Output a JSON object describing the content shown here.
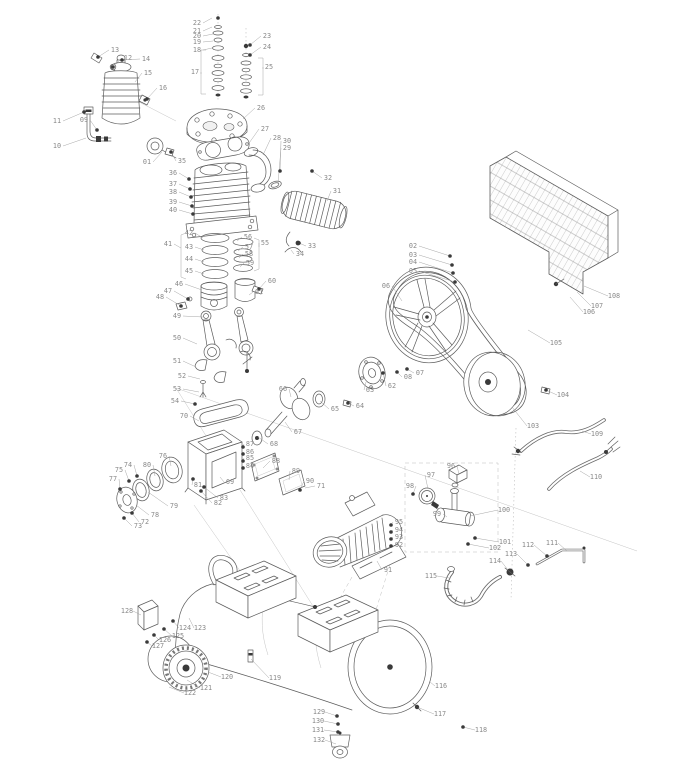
{
  "figure": {
    "kind": "exploded-parts-diagram",
    "subject": "belt-driven air compressor"
  },
  "colors": {
    "line": "#5c5c5c",
    "label": "#8a8a8a",
    "fastener": "#3a3a3a",
    "background": "#ffffff"
  },
  "parts": [
    {
      "n": "01",
      "x": 147,
      "y": 164,
      "tx": 162,
      "ty": 152,
      "f": 0
    },
    {
      "n": "02",
      "x": 413,
      "y": 248,
      "tx": 450,
      "ty": 256,
      "f": 1
    },
    {
      "n": "03",
      "x": 413,
      "y": 257,
      "tx": 452,
      "ty": 265,
      "f": 1
    },
    {
      "n": "04",
      "x": 413,
      "y": 264,
      "tx": 453,
      "ty": 273,
      "f": 1
    },
    {
      "n": "05",
      "x": 413,
      "y": 273,
      "tx": 455,
      "ty": 282,
      "f": 1
    },
    {
      "n": "06",
      "x": 386,
      "y": 288,
      "tx": 402,
      "ty": 301,
      "f": 0
    },
    {
      "n": "07",
      "x": 420,
      "y": 375,
      "tx": 407,
      "ty": 369,
      "f": 1
    },
    {
      "n": "08",
      "x": 408,
      "y": 379,
      "tx": 397,
      "ty": 372,
      "f": 1
    },
    {
      "n": "09",
      "x": 84,
      "y": 122,
      "tx": 97,
      "ty": 130,
      "f": 1
    },
    {
      "n": "10",
      "x": 57,
      "y": 148,
      "tx": 86,
      "ty": 138,
      "f": 0
    },
    {
      "n": "11",
      "x": 57,
      "y": 123,
      "tx": 84,
      "ty": 112,
      "f": 1
    },
    {
      "n": "12",
      "x": 128,
      "y": 60,
      "tx": 113,
      "ty": 67,
      "f": 1
    },
    {
      "n": "13",
      "x": 115,
      "y": 52,
      "tx": 98,
      "ty": 57,
      "f": 1
    },
    {
      "n": "14",
      "x": 146,
      "y": 61,
      "tx": 122,
      "ty": 60,
      "f": 1
    },
    {
      "n": "15",
      "x": 148,
      "y": 75,
      "tx": 135,
      "ty": 82,
      "f": 0
    },
    {
      "n": "16",
      "x": 163,
      "y": 90,
      "tx": 147,
      "ty": 99,
      "f": 1
    },
    {
      "n": "17",
      "x": 195,
      "y": 74,
      "tx": 201,
      "ty": 74,
      "f": 0
    },
    {
      "n": "18",
      "x": 197,
      "y": 52,
      "tx": 212,
      "ty": 48,
      "f": 0
    },
    {
      "n": "19",
      "x": 197,
      "y": 44,
      "tx": 213,
      "ty": 41,
      "f": 0
    },
    {
      "n": "20",
      "x": 197,
      "y": 38,
      "tx": 213,
      "ty": 34,
      "f": 0
    },
    {
      "n": "21",
      "x": 197,
      "y": 33,
      "tx": 212,
      "ty": 27,
      "f": 0
    },
    {
      "n": "22",
      "x": 197,
      "y": 25,
      "tx": 212,
      "ty": 18,
      "f": 0
    },
    {
      "n": "23",
      "x": 267,
      "y": 38,
      "tx": 250,
      "ty": 45,
      "f": 1
    },
    {
      "n": "24",
      "x": 267,
      "y": 49,
      "tx": 250,
      "ty": 55,
      "f": 1
    },
    {
      "n": "25",
      "x": 269,
      "y": 69,
      "tx": 263,
      "ty": 69,
      "f": 0
    },
    {
      "n": "26",
      "x": 261,
      "y": 110,
      "tx": 243,
      "ty": 119,
      "f": 0
    },
    {
      "n": "27",
      "x": 265,
      "y": 131,
      "tx": 247,
      "ty": 146,
      "f": 0
    },
    {
      "n": "28",
      "x": 277,
      "y": 140,
      "tx": 263,
      "ty": 155,
      "f": 0
    },
    {
      "n": "29",
      "x": 287,
      "y": 150,
      "tx": 278,
      "ty": 184,
      "f": 0
    },
    {
      "n": "30",
      "x": 287,
      "y": 143,
      "tx": 280,
      "ty": 171,
      "f": 1
    },
    {
      "n": "31",
      "x": 337,
      "y": 193,
      "tx": 327,
      "ty": 201,
      "f": 0
    },
    {
      "n": "32",
      "x": 328,
      "y": 180,
      "tx": 312,
      "ty": 171,
      "f": 1
    },
    {
      "n": "33",
      "x": 312,
      "y": 248,
      "tx": 299,
      "ty": 243,
      "f": 1
    },
    {
      "n": "34",
      "x": 300,
      "y": 256,
      "tx": 291,
      "ty": 250,
      "f": 0
    },
    {
      "n": "35",
      "x": 182,
      "y": 163,
      "tx": 171,
      "ty": 152,
      "f": 1
    },
    {
      "n": "36",
      "x": 173,
      "y": 175,
      "tx": 189,
      "ty": 179,
      "f": 1
    },
    {
      "n": "37",
      "x": 173,
      "y": 186,
      "tx": 190,
      "ty": 189,
      "f": 1
    },
    {
      "n": "38",
      "x": 173,
      "y": 194,
      "tx": 191,
      "ty": 197,
      "f": 1
    },
    {
      "n": "39",
      "x": 173,
      "y": 204,
      "tx": 192,
      "ty": 206,
      "f": 1
    },
    {
      "n": "40",
      "x": 173,
      "y": 212,
      "tx": 193,
      "ty": 214,
      "f": 1
    },
    {
      "n": "41",
      "x": 168,
      "y": 246,
      "tx": 181,
      "ty": 248,
      "f": 0
    },
    {
      "n": "42",
      "x": 189,
      "y": 235,
      "tx": 203,
      "ty": 238,
      "f": 0
    },
    {
      "n": "43",
      "x": 189,
      "y": 249,
      "tx": 204,
      "ty": 250,
      "f": 0
    },
    {
      "n": "44",
      "x": 189,
      "y": 261,
      "tx": 204,
      "ty": 262,
      "f": 0
    },
    {
      "n": "45",
      "x": 189,
      "y": 273,
      "tx": 204,
      "ty": 274,
      "f": 0
    },
    {
      "n": "46",
      "x": 179,
      "y": 286,
      "tx": 202,
      "ty": 290,
      "f": 0
    },
    {
      "n": "47",
      "x": 168,
      "y": 293,
      "tx": 188,
      "ty": 299,
      "f": 1
    },
    {
      "n": "48",
      "x": 160,
      "y": 299,
      "tx": 181,
      "ty": 306,
      "f": 1
    },
    {
      "n": "49",
      "x": 177,
      "y": 318,
      "tx": 203,
      "ty": 317,
      "f": 0
    },
    {
      "n": "50",
      "x": 177,
      "y": 340,
      "tx": 197,
      "ty": 344,
      "f": 0
    },
    {
      "n": "51",
      "x": 177,
      "y": 363,
      "tx": 196,
      "ty": 367,
      "f": 0
    },
    {
      "n": "52",
      "x": 182,
      "y": 378,
      "tx": 200,
      "ty": 379,
      "f": 0
    },
    {
      "n": "53",
      "x": 177,
      "y": 391,
      "tx": 199,
      "ty": 392,
      "f": 0
    },
    {
      "n": "54",
      "x": 175,
      "y": 403,
      "tx": 195,
      "ty": 404,
      "f": 1
    },
    {
      "n": "55",
      "x": 265,
      "y": 245,
      "tx": 259,
      "ty": 247,
      "f": 0
    },
    {
      "n": "56",
      "x": 248,
      "y": 239,
      "tx": 237,
      "ty": 241,
      "f": 0
    },
    {
      "n": "57",
      "x": 249,
      "y": 249,
      "tx": 238,
      "ty": 251,
      "f": 0
    },
    {
      "n": "58",
      "x": 249,
      "y": 256,
      "tx": 239,
      "ty": 258,
      "f": 0
    },
    {
      "n": "59",
      "x": 250,
      "y": 265,
      "tx": 240,
      "ty": 267,
      "f": 0
    },
    {
      "n": "60",
      "x": 272,
      "y": 283,
      "tx": 259,
      "ty": 289,
      "f": 1
    },
    {
      "n": "61",
      "x": 259,
      "y": 294,
      "tx": 249,
      "ty": 295,
      "f": 0
    },
    {
      "n": "62",
      "x": 392,
      "y": 388,
      "tx": 383,
      "ty": 373,
      "f": 1
    },
    {
      "n": "63",
      "x": 370,
      "y": 392,
      "tx": 366,
      "ty": 382,
      "f": 0
    },
    {
      "n": "64",
      "x": 360,
      "y": 408,
      "tx": 348,
      "ty": 403,
      "f": 1
    },
    {
      "n": "65",
      "x": 335,
      "y": 411,
      "tx": 320,
      "ty": 401,
      "f": 0
    },
    {
      "n": "66",
      "x": 283,
      "y": 391,
      "tx": 291,
      "ty": 397,
      "f": 0
    },
    {
      "n": "67",
      "x": 298,
      "y": 434,
      "tx": 285,
      "ty": 422,
      "f": 0
    },
    {
      "n": "68",
      "x": 274,
      "y": 446,
      "tx": 258,
      "ty": 437,
      "f": 0
    },
    {
      "n": "69",
      "x": 230,
      "y": 484,
      "tx": 220,
      "ty": 477,
      "f": 0
    },
    {
      "n": "70",
      "x": 184,
      "y": 418,
      "tx": 199,
      "ty": 421,
      "f": 0
    },
    {
      "n": "71",
      "x": 321,
      "y": 488,
      "tx": 305,
      "ty": 488,
      "f": 0
    },
    {
      "n": "72",
      "x": 145,
      "y": 524,
      "tx": 132,
      "ty": 513,
      "f": 1
    },
    {
      "n": "73",
      "x": 138,
      "y": 528,
      "tx": 124,
      "ty": 518,
      "f": 1
    },
    {
      "n": "74",
      "x": 128,
      "y": 467,
      "tx": 137,
      "ty": 476,
      "f": 1
    },
    {
      "n": "75",
      "x": 119,
      "y": 472,
      "tx": 129,
      "ty": 481,
      "f": 1
    },
    {
      "n": "76",
      "x": 163,
      "y": 458,
      "tx": 171,
      "ty": 466,
      "f": 0
    },
    {
      "n": "77",
      "x": 113,
      "y": 481,
      "tx": 120,
      "ty": 489,
      "f": 1
    },
    {
      "n": "78",
      "x": 155,
      "y": 517,
      "tx": 136,
      "ty": 505,
      "f": 0
    },
    {
      "n": "79",
      "x": 174,
      "y": 508,
      "tx": 148,
      "ty": 492,
      "f": 0
    },
    {
      "n": "80",
      "x": 147,
      "y": 467,
      "tx": 155,
      "ty": 476,
      "f": 0
    },
    {
      "n": "81",
      "x": 198,
      "y": 487,
      "tx": 193,
      "ty": 479,
      "f": 1
    },
    {
      "n": "82",
      "x": 218,
      "y": 505,
      "tx": 201,
      "ty": 491,
      "f": 1
    },
    {
      "n": "83",
      "x": 224,
      "y": 500,
      "tx": 204,
      "ty": 487,
      "f": 1
    },
    {
      "n": "84",
      "x": 250,
      "y": 468,
      "tx": 243,
      "ty": 468,
      "f": 1
    },
    {
      "n": "85",
      "x": 250,
      "y": 460,
      "tx": 243,
      "ty": 461,
      "f": 1
    },
    {
      "n": "86",
      "x": 250,
      "y": 454,
      "tx": 243,
      "ty": 454,
      "f": 1
    },
    {
      "n": "87",
      "x": 250,
      "y": 446,
      "tx": 243,
      "ty": 447,
      "f": 1
    },
    {
      "n": "88",
      "x": 276,
      "y": 463,
      "tx": 263,
      "ty": 468,
      "f": 0
    },
    {
      "n": "89",
      "x": 296,
      "y": 473,
      "tx": 289,
      "ty": 480,
      "f": 0
    },
    {
      "n": "90",
      "x": 310,
      "y": 483,
      "tx": 300,
      "ty": 490,
      "f": 1
    },
    {
      "n": "91",
      "x": 388,
      "y": 572,
      "tx": 377,
      "ty": 561,
      "f": 0
    },
    {
      "n": "92",
      "x": 399,
      "y": 547,
      "tx": 391,
      "ty": 546,
      "f": 1
    },
    {
      "n": "93",
      "x": 399,
      "y": 539,
      "tx": 391,
      "ty": 539,
      "f": 1
    },
    {
      "n": "94",
      "x": 399,
      "y": 532,
      "tx": 391,
      "ty": 532,
      "f": 1
    },
    {
      "n": "95",
      "x": 399,
      "y": 524,
      "tx": 391,
      "ty": 525,
      "f": 1
    },
    {
      "n": "96",
      "x": 451,
      "y": 468,
      "tx": 459,
      "ty": 474,
      "f": 0
    },
    {
      "n": "97",
      "x": 431,
      "y": 477,
      "tx": 428,
      "ty": 489,
      "f": 0
    },
    {
      "n": "98",
      "x": 410,
      "y": 488,
      "tx": 413,
      "ty": 494,
      "f": 1
    },
    {
      "n": "99",
      "x": 437,
      "y": 516,
      "tx": 447,
      "ty": 517,
      "f": 0
    },
    {
      "n": "100",
      "x": 504,
      "y": 512,
      "tx": 470,
      "ty": 516,
      "f": 0
    },
    {
      "n": "101",
      "x": 505,
      "y": 544,
      "tx": 475,
      "ty": 538,
      "f": 1
    },
    {
      "n": "102",
      "x": 495,
      "y": 550,
      "tx": 468,
      "ty": 544,
      "f": 1
    },
    {
      "n": "103",
      "x": 533,
      "y": 428,
      "tx": 512,
      "ty": 407,
      "f": 0
    },
    {
      "n": "104",
      "x": 563,
      "y": 397,
      "tx": 546,
      "ty": 390,
      "f": 1
    },
    {
      "n": "105",
      "x": 556,
      "y": 345,
      "tx": 528,
      "ty": 330,
      "f": 0
    },
    {
      "n": "106",
      "x": 589,
      "y": 314,
      "tx": 570,
      "ty": 297,
      "f": 0
    },
    {
      "n": "107",
      "x": 597,
      "y": 308,
      "tx": 577,
      "ty": 292,
      "f": 0
    },
    {
      "n": "108",
      "x": 614,
      "y": 298,
      "tx": 584,
      "ty": 286,
      "f": 0
    },
    {
      "n": "109",
      "x": 597,
      "y": 436,
      "tx": 582,
      "ty": 431,
      "f": 0
    },
    {
      "n": "110",
      "x": 596,
      "y": 479,
      "tx": 580,
      "ty": 471,
      "f": 0
    },
    {
      "n": "111",
      "x": 552,
      "y": 545,
      "tx": 567,
      "ty": 551,
      "f": 0
    },
    {
      "n": "112",
      "x": 528,
      "y": 547,
      "tx": 547,
      "ty": 556,
      "f": 1
    },
    {
      "n": "113",
      "x": 511,
      "y": 556,
      "tx": 528,
      "ty": 565,
      "f": 1
    },
    {
      "n": "114",
      "x": 495,
      "y": 563,
      "tx": 508,
      "ty": 570,
      "f": 0
    },
    {
      "n": "115",
      "x": 431,
      "y": 578,
      "tx": 449,
      "ty": 578,
      "f": 0
    },
    {
      "n": "116",
      "x": 441,
      "y": 688,
      "tx": 430,
      "ty": 682,
      "f": 0
    },
    {
      "n": "117",
      "x": 440,
      "y": 716,
      "tx": 417,
      "ty": 707,
      "f": 1
    },
    {
      "n": "118",
      "x": 481,
      "y": 732,
      "tx": 463,
      "ty": 727,
      "f": 1
    },
    {
      "n": "119",
      "x": 275,
      "y": 680,
      "tx": 251,
      "ty": 659,
      "f": 0
    },
    {
      "n": "120",
      "x": 227,
      "y": 679,
      "tx": 208,
      "ty": 672,
      "f": 0
    },
    {
      "n": "121",
      "x": 206,
      "y": 690,
      "tx": 187,
      "ty": 680,
      "f": 0
    },
    {
      "n": "122",
      "x": 190,
      "y": 695,
      "tx": 169,
      "ty": 687,
      "f": 0
    },
    {
      "n": "123",
      "x": 200,
      "y": 630,
      "tx": 189,
      "ty": 618,
      "f": 0
    },
    {
      "n": "124",
      "x": 185,
      "y": 630,
      "tx": 173,
      "ty": 621,
      "f": 1
    },
    {
      "n": "125",
      "x": 178,
      "y": 638,
      "tx": 164,
      "ty": 629,
      "f": 1
    },
    {
      "n": "126",
      "x": 165,
      "y": 642,
      "tx": 154,
      "ty": 635,
      "f": 1
    },
    {
      "n": "127",
      "x": 158,
      "y": 648,
      "tx": 147,
      "ty": 642,
      "f": 1
    },
    {
      "n": "128",
      "x": 127,
      "y": 613,
      "tx": 141,
      "ty": 615,
      "f": 0
    },
    {
      "n": "129",
      "x": 319,
      "y": 714,
      "tx": 337,
      "ty": 716,
      "f": 1
    },
    {
      "n": "130",
      "x": 318,
      "y": 723,
      "tx": 338,
      "ty": 724,
      "f": 1
    },
    {
      "n": "131",
      "x": 318,
      "y": 732,
      "tx": 338,
      "ty": 732,
      "f": 1
    },
    {
      "n": "132",
      "x": 319,
      "y": 742,
      "tx": 336,
      "ty": 744,
      "f": 0
    }
  ]
}
